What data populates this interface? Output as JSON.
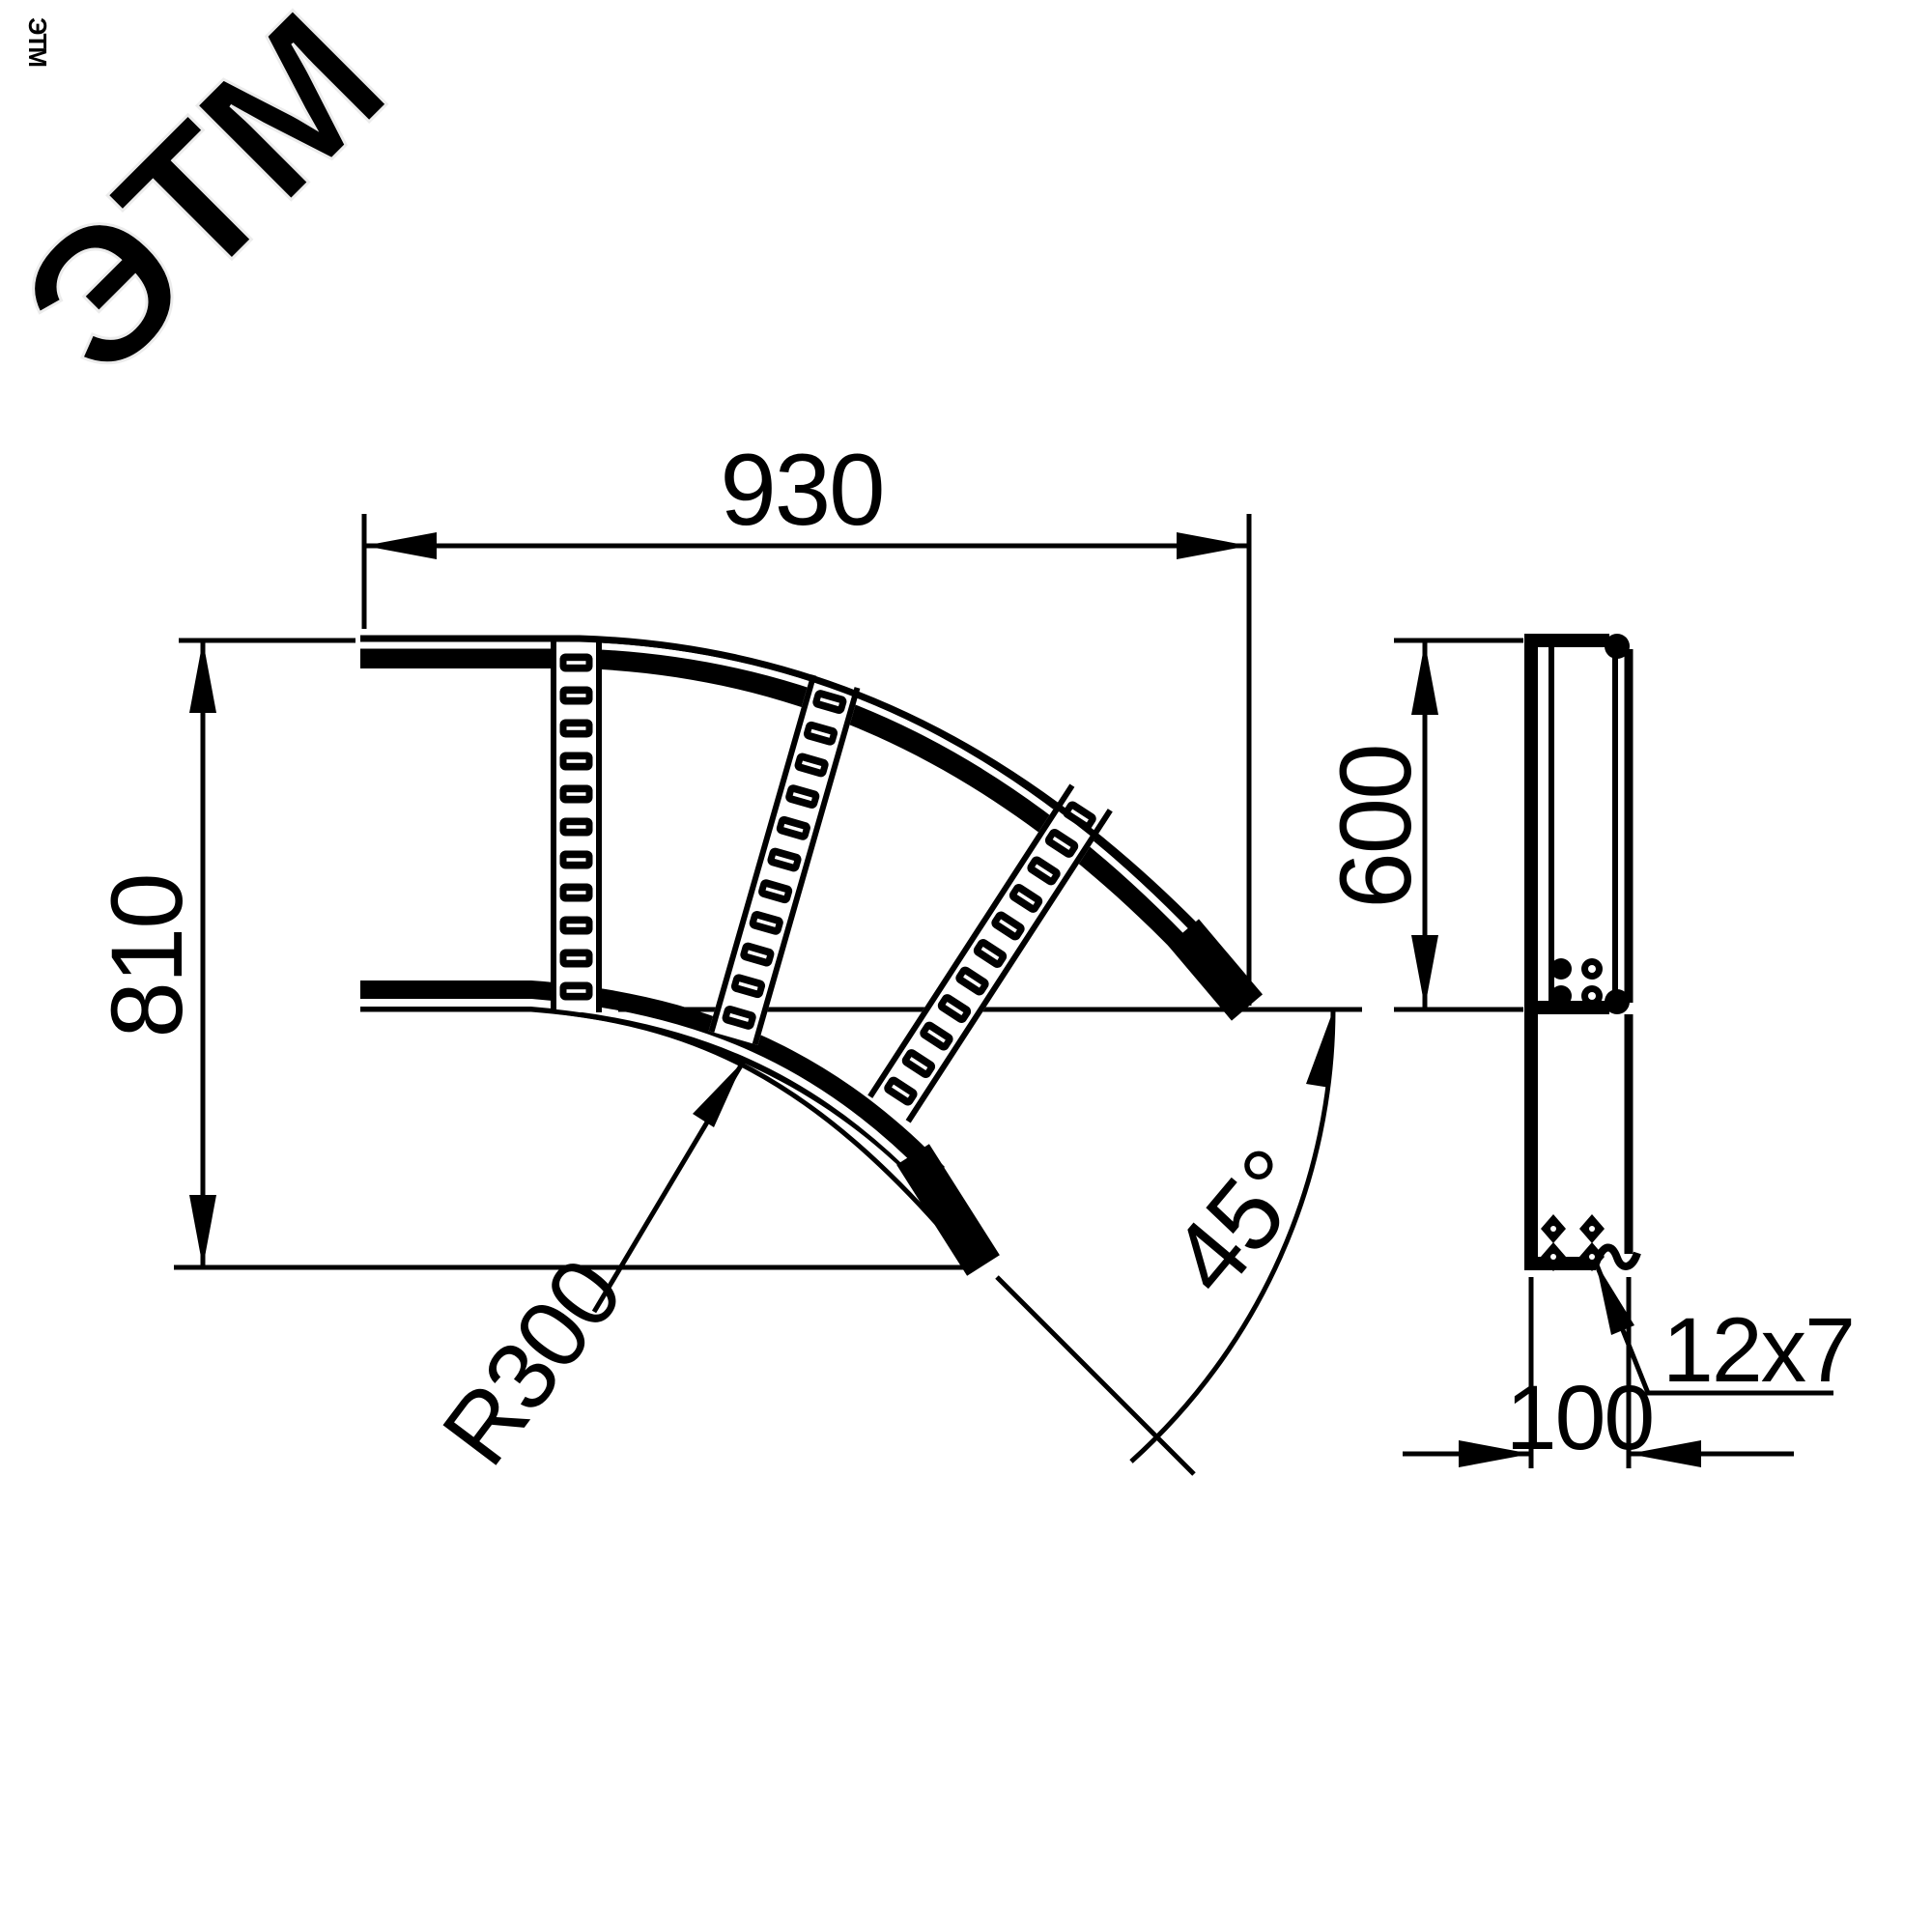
{
  "watermark": {
    "brand": "ЭТМ",
    "brand_small": "ЭТМ"
  },
  "colors": {
    "line": "#000000",
    "background": "#ffffff",
    "watermark": "#ececec"
  },
  "plan_view": {
    "width_dim": "930",
    "height_dim": "810",
    "radius_dim": "R300",
    "angle_dim": "45°"
  },
  "side_view": {
    "height_dim": "600",
    "width_dim": "100",
    "hole_dim": "12x7"
  }
}
